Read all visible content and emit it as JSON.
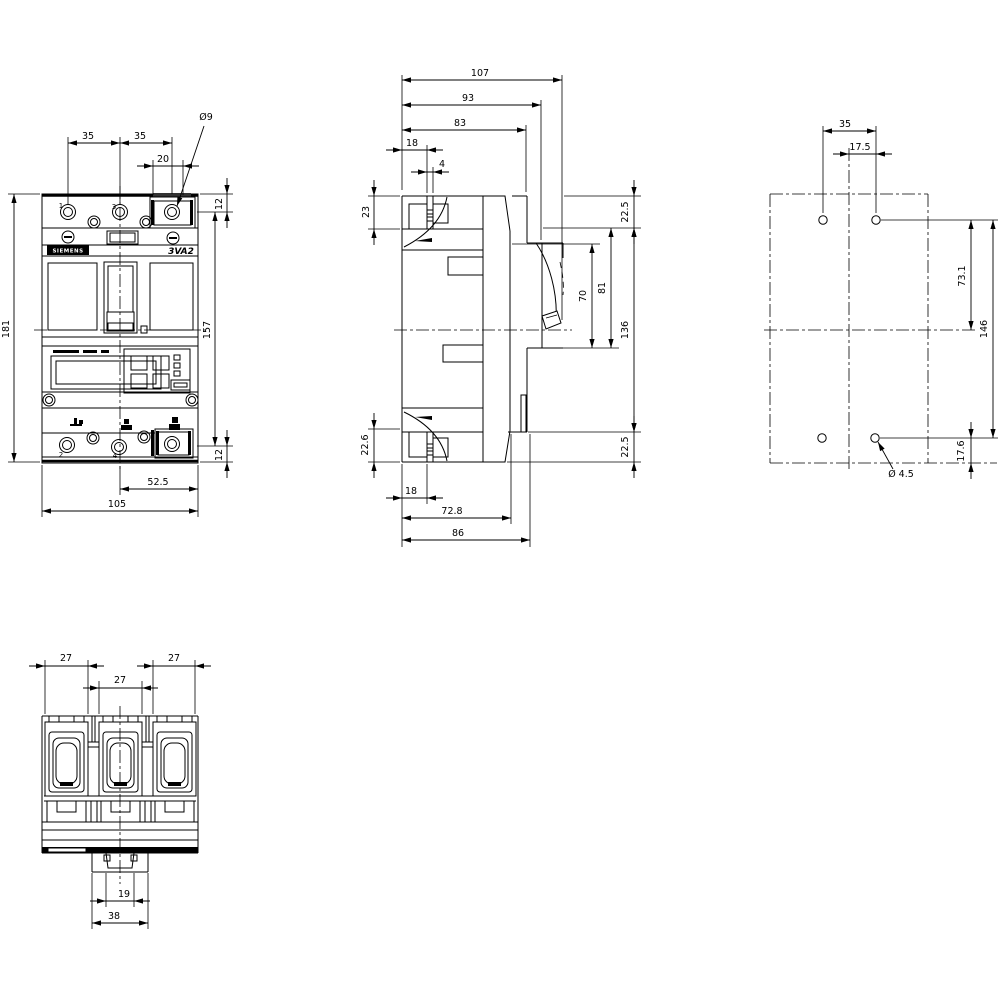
{
  "brand": "SIEMENS",
  "model": "3VA2",
  "terminals": {
    "t1": "1",
    "t3": "3",
    "t2": "2",
    "t4": "4"
  },
  "front": {
    "pitch_a": "35",
    "pitch_b": "35",
    "clamp_w": "20",
    "hole_dia": "Ø9",
    "off_top": "12",
    "height": "181",
    "span": "157",
    "off_bot": "12",
    "half_w": "52.5",
    "width": "105"
  },
  "side": {
    "d107": "107",
    "d93": "93",
    "d83": "83",
    "d18t": "18",
    "d4": "4",
    "d23": "23",
    "d225t": "22.5",
    "d81": "81",
    "d70": "70",
    "d136": "136",
    "d225b": "22.5",
    "d226": "22.6",
    "d18b": "18",
    "d728": "72.8",
    "d86": "86"
  },
  "mount": {
    "pitch_x": "35",
    "half_x": "17.5",
    "d731": "73.1",
    "pitch_y": "146",
    "d176": "17.6",
    "hole_dia": "Ø 4.5"
  },
  "bottom": {
    "w27a": "27",
    "w27b": "27",
    "w27c": "27",
    "slot19": "19",
    "foot38": "38"
  }
}
